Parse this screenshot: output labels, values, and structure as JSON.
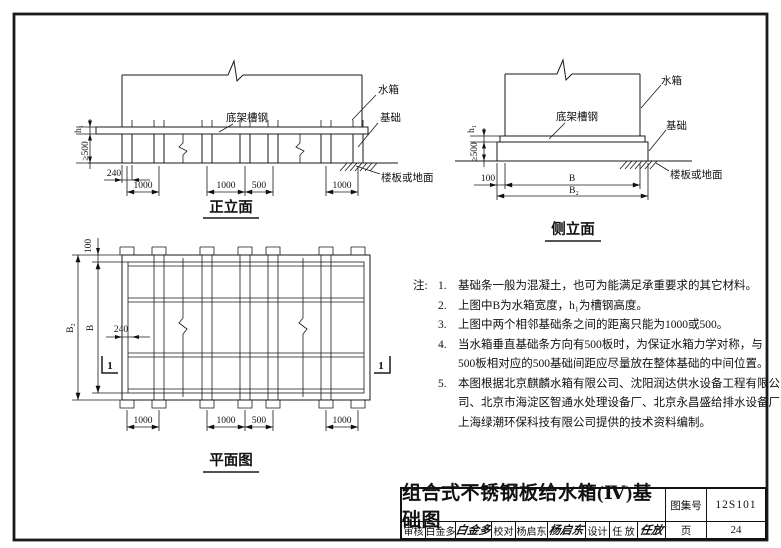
{
  "page": {
    "background": "#ffffff",
    "ink": "#1a1a1a"
  },
  "front": {
    "title": "正立面",
    "label_tank": "水箱",
    "label_channel": "底架槽钢",
    "label_foundation": "基础",
    "label_ground": "楼板或地面",
    "dim_h1": "h₁",
    "dim_min500": "≥500",
    "dim_240": "240",
    "dims_bottom": [
      "1000",
      "1000",
      "500",
      "1000"
    ]
  },
  "side": {
    "title": "侧立面",
    "label_tank": "水箱",
    "label_channel": "底架槽钢",
    "label_foundation": "基础",
    "label_ground": "楼板或地面",
    "dim_h1": "h₁",
    "dim_min500": "≥500",
    "dim_100": "100",
    "dim_B": "B",
    "dim_B2": "B₂"
  },
  "plan": {
    "title": "平面图",
    "dim_100": "100",
    "dim_B2": "B₂",
    "dim_B": "B",
    "dim_240": "240",
    "dims_bottom": [
      "1000",
      "1000",
      "500",
      "1000"
    ],
    "section_left": "1",
    "section_right": "1"
  },
  "notes": {
    "prefix": "注:",
    "items": [
      {
        "num": "1.",
        "lines": [
          "基础条一般为混凝土，也可为能满足承重要求的其它材料。"
        ]
      },
      {
        "num": "2.",
        "lines": [
          "上图中B为水箱宽度，h₁为槽钢高度。"
        ]
      },
      {
        "num": "3.",
        "lines": [
          "上图中两个相邻基础条之间的距离只能为1000或500。"
        ]
      },
      {
        "num": "4.",
        "lines": [
          "当水箱垂直基础条方向有500板时，为保证水箱力学对称，与",
          "500板相对应的500基础间距应尽量放在整体基础的中间位置。"
        ]
      },
      {
        "num": "5.",
        "lines": [
          "本图根据北京麒麟水箱有限公司、沈阳润达供水设备工程有限公",
          "司、北京市海淀区智通水处理设备厂、北京永昌盛给排水设备厂、",
          "上海绿潮环保科技有限公司提供的技术资料编制。"
        ]
      }
    ]
  },
  "title_block": {
    "title": "组合式不锈钢板给水箱(Ⅳ)基础图",
    "atlas_label": "图集号",
    "atlas_no": "12S101",
    "page_label": "页",
    "page_no": "24",
    "review_label": "审核",
    "reviewer": "白金多",
    "reviewer_sig": "白金多",
    "check_label": "校对",
    "checker": "杨启东",
    "checker_sig": "杨启东",
    "design_label": "设计",
    "designer": "任 放",
    "designer_sig": "任放"
  }
}
